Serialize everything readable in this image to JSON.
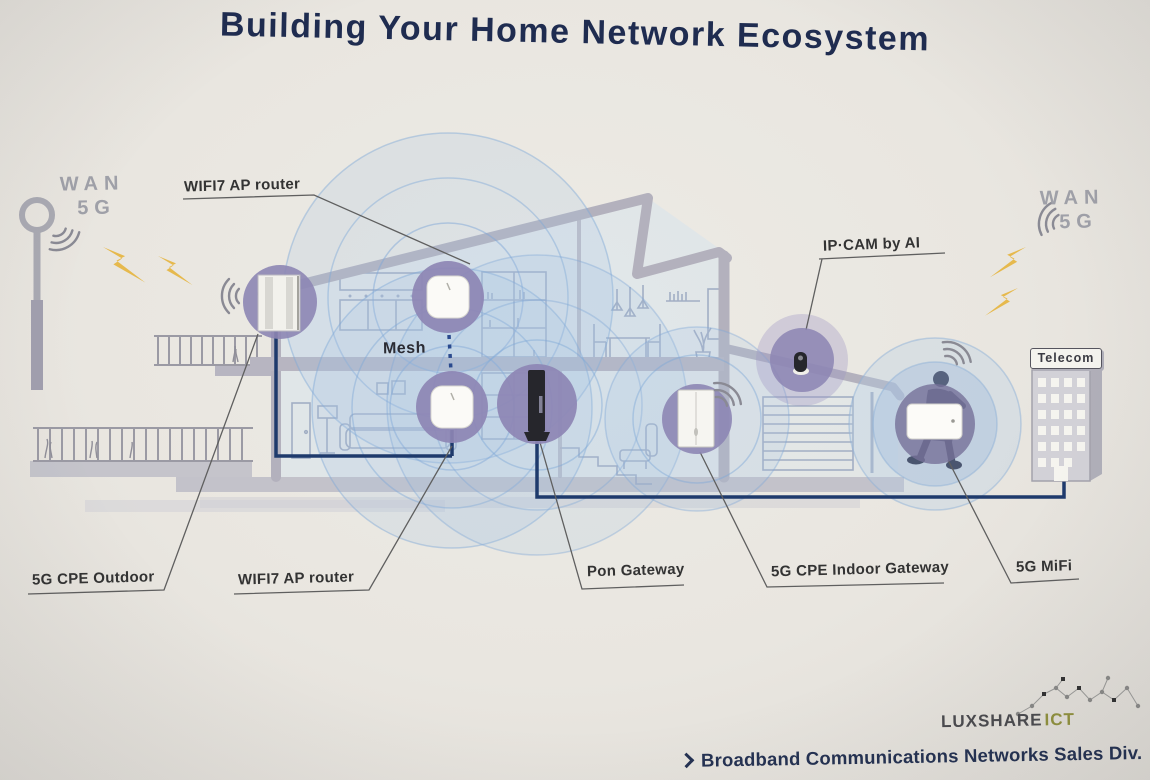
{
  "title": "Building Your Home Network Ecosystem",
  "wan_left": {
    "line1": "WAN",
    "line2": "5G"
  },
  "wan_right": {
    "line1": "WAN",
    "line2": "5G"
  },
  "house": {
    "mesh_label": "Mesh",
    "telecom_sign": "Telecom"
  },
  "device_labels": {
    "wifi7_top": "WIFI7 AP router",
    "ipcam": "IP·CAM by AI",
    "cpe_outdoor": "5G CPE Outdoor",
    "wifi7_bottom": "WIFI7 AP router",
    "pon_gateway": "Pon Gateway",
    "cpe_indoor": "5G CPE Indoor Gateway",
    "mifi": "5G MiFi"
  },
  "branding": {
    "company": "LUXSHARE",
    "unit": "ICT",
    "footer": "Broadband Communications Networks Sales Div."
  },
  "icons": {
    "wifi_waves": "wifi-signal-arcs",
    "lightning": "wireless-link-bolt",
    "chevron": "footer-chevron",
    "constellation": "network-constellation",
    "tower": "5g-antenna-pole"
  },
  "colors": {
    "background": "#e9e6e0",
    "title_navy": "#1f2c50",
    "cable_navy": "#1e3a6c",
    "device_circle_purple": "#8d86b4",
    "coverage_blue": "#7fa8d8",
    "structure_gray": "#b3b1bd",
    "lightning_gold": "#e6b94d",
    "wan_gray": "#9fa0a8",
    "ict_olive": "#90913f",
    "label_dark": "#333333"
  }
}
